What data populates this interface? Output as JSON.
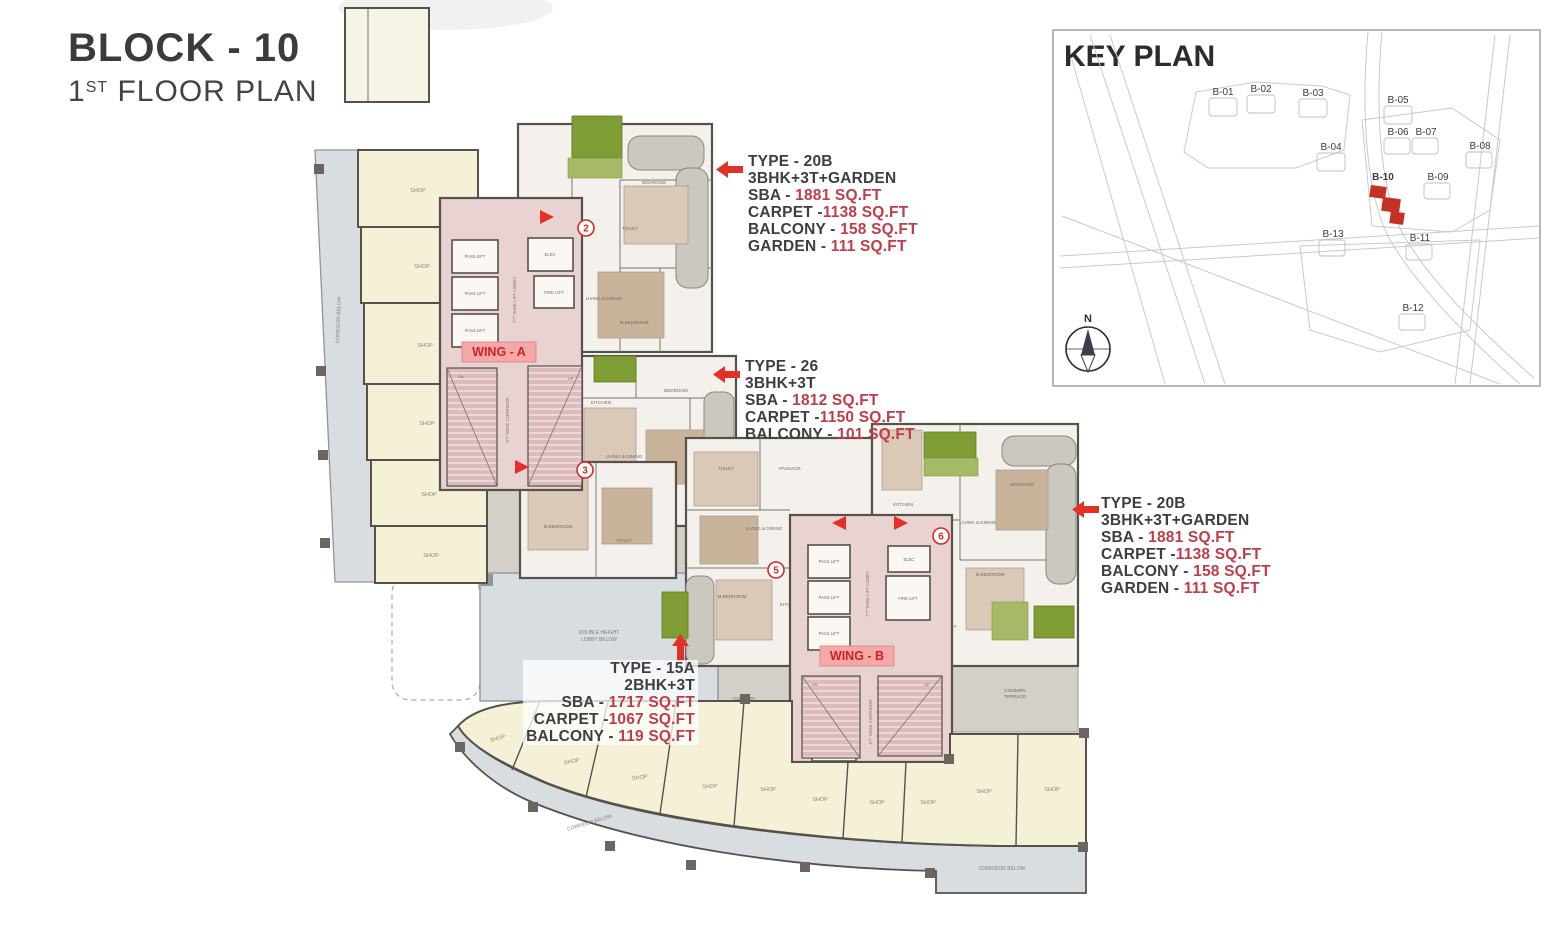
{
  "title": {
    "block": "BLOCK - 10",
    "floor_num": "1",
    "floor_sup": "ST",
    "floor_rest": " FLOOR PLAN"
  },
  "key_plan": {
    "title": "KEY PLAN",
    "compass": "N",
    "blocks": [
      {
        "label": "B-01",
        "highlight": false
      },
      {
        "label": "B-02",
        "highlight": false
      },
      {
        "label": "B-03",
        "highlight": false
      },
      {
        "label": "B-04",
        "highlight": false
      },
      {
        "label": "B-05",
        "highlight": false
      },
      {
        "label": "B-06",
        "highlight": false
      },
      {
        "label": "B-07",
        "highlight": false
      },
      {
        "label": "B-08",
        "highlight": false
      },
      {
        "label": "B-09",
        "highlight": false
      },
      {
        "label": "B-10",
        "highlight": true
      },
      {
        "label": "B-11",
        "highlight": false
      },
      {
        "label": "B-12",
        "highlight": false
      },
      {
        "label": "B-13",
        "highlight": false
      }
    ]
  },
  "wings": {
    "a": "WING - A",
    "b": "WING - B"
  },
  "units": {
    "u2": "2",
    "u3": "3",
    "u5": "5",
    "u6": "6"
  },
  "annotations": [
    {
      "type": "TYPE - 20B",
      "config": "3BHK+3T+GARDEN",
      "lines": [
        {
          "label": "SBA - ",
          "value": "1881 SQ.FT"
        },
        {
          "label": "CARPET -",
          "value": "1138 SQ.FT"
        },
        {
          "label": "BALCONY - ",
          "value": "158 SQ.FT"
        },
        {
          "label": "GARDEN - ",
          "value": "111 SQ.FT"
        }
      ]
    },
    {
      "type": "TYPE - 26",
      "config": "3BHK+3T",
      "lines": [
        {
          "label": "SBA - ",
          "value": "1812 SQ.FT"
        },
        {
          "label": "CARPET -",
          "value": "1150 SQ.FT"
        },
        {
          "label": "BALCONY - ",
          "value": "101 SQ.FT"
        }
      ]
    },
    {
      "type": "TYPE - 20B",
      "config": "3BHK+3T+GARDEN",
      "lines": [
        {
          "label": "SBA - ",
          "value": "1881 SQ.FT"
        },
        {
          "label": "CARPET -",
          "value": "1138 SQ.FT"
        },
        {
          "label": "BALCONY - ",
          "value": "158 SQ.FT"
        },
        {
          "label": "GARDEN - ",
          "value": "111 SQ.FT"
        }
      ]
    },
    {
      "type": "TYPE - 15A",
      "config": "2BHK+3T",
      "lines": [
        {
          "label": "SBA - ",
          "value": "1717 SQ.FT"
        },
        {
          "label": "CARPET -",
          "value": "1067 SQ.FT"
        },
        {
          "label": "BALCONY - ",
          "value": "119 SQ.FT"
        }
      ]
    }
  ],
  "plan_labels": {
    "shop": "SHOP",
    "corridor_below": "CORRIDOR BELOW",
    "common": "COMMON",
    "terrace": "TERRACE",
    "double_height": "DOUBLE HEIGHT",
    "lobby_below": "LOBBY BELOW",
    "pass_lift": "PASS LIFT",
    "fire_lift": "FIRE LIFT",
    "elec": "ELEC",
    "comm": "COMM",
    "lift_lobby": "7'7\" WIDE LIFT LOBBY",
    "wide_corridor": "6'7\" WIDE CORRIDOR",
    "dn": "DN",
    "up": "UP",
    "foyer": "FOYER",
    "kitchen": "KITCHEN",
    "living_dining": "LIVING & DINING",
    "bedroom": "BEDROOM",
    "master_bedroom": "M.BEDROOM",
    "toilet": "TOILET",
    "passage": "PASSAGE",
    "utility": "UTILITY"
  },
  "colors": {
    "accent_red": "#e23125",
    "value_red": "#bf3d48",
    "shop_fill": "#f4f1d7",
    "corridor_fill": "#d8dde2",
    "core_pink": "#e9d2d2",
    "terrace_gray": "#d3d0c8",
    "garden_green": "#7f9c35"
  }
}
